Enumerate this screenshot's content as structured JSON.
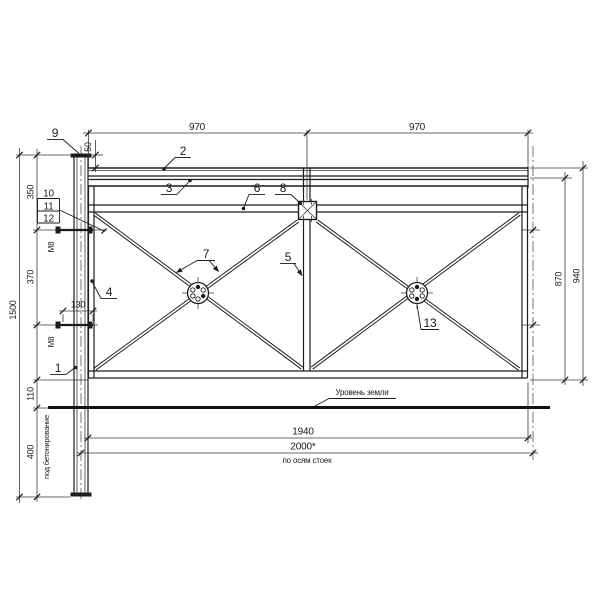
{
  "labels": {
    "ground_level": "Уровень земли",
    "along_post_axes": "по осям стоек",
    "for_concreting": "под бетонирование"
  },
  "dimensions": {
    "top_left_span": "970",
    "top_right_span": "970",
    "post_cap_offset": "50",
    "left_seg_1": "350",
    "left_seg_2": "370",
    "left_seg_3": "110",
    "left_seg_4": "400",
    "total_height": "1500",
    "bolt_length": "130",
    "panel_height": "870",
    "overall_panel_height": "940",
    "panel_length": "1940",
    "post_axes_span": "2000*",
    "bolt_upper": "М8",
    "bolt_lower": "М8"
  },
  "callouts": {
    "c1": "1",
    "c2": "2",
    "c3": "3",
    "c4": "4",
    "c5": "5",
    "c6": "6",
    "c7": "7",
    "c8": "8",
    "c9": "9",
    "c10": "10",
    "c11": "11",
    "c12": "12",
    "c13": "13"
  }
}
